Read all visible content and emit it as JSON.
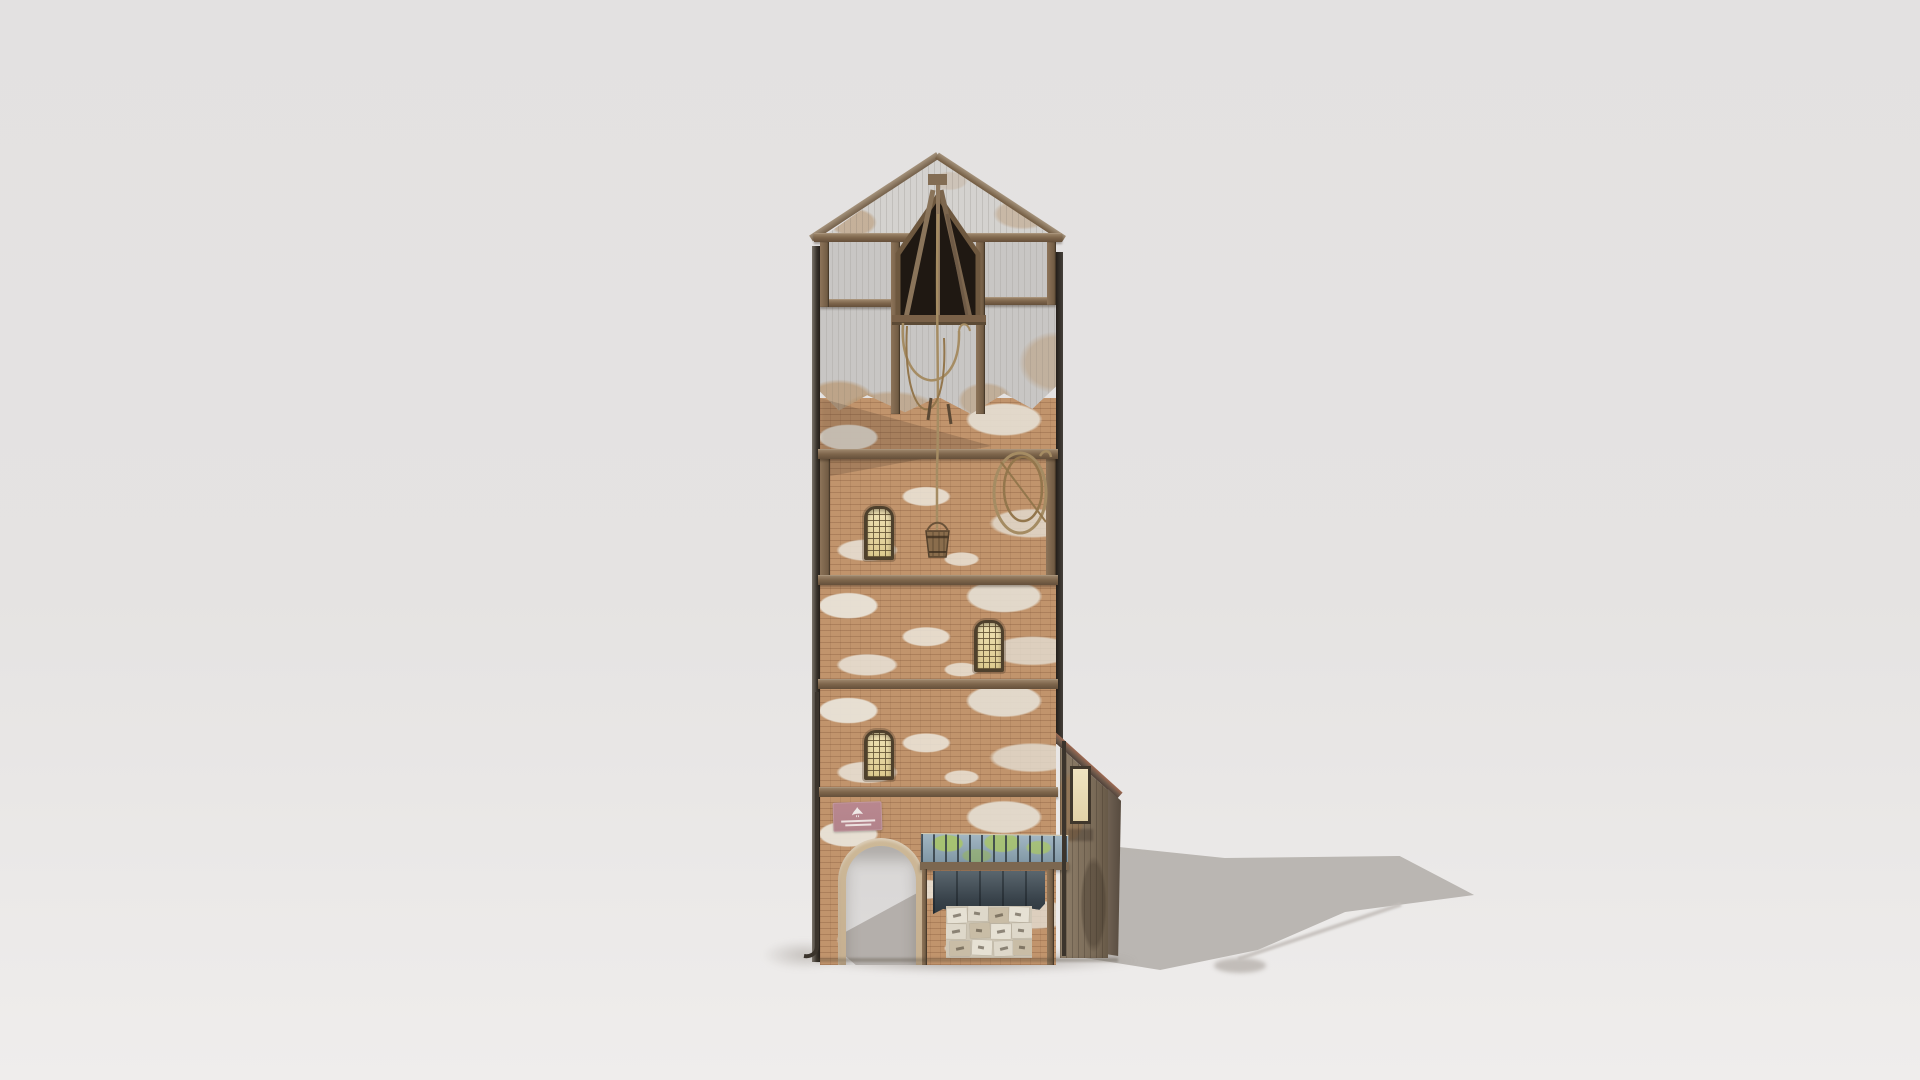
{
  "scene": {
    "type": "3d_render",
    "subject": "tall weathered brick-and-timber tower house with gabled hoist loft, arched passage, boarded shopfront and wooden lean-to shed",
    "background": "#e4e2e1",
    "ground": "#efedec",
    "shadow_color": "#b6b1ad",
    "shadow_direction": "cast to the right of the building"
  },
  "building": {
    "name": "medieval-tower-house",
    "palette": {
      "brick": "#c1946c",
      "plaster": "#c8c6c4",
      "gable_siding": "#d4d2cf",
      "wood": "#7e664c",
      "wood_dark": "#5f4a35",
      "opening_dark": "#1f1812",
      "window_pane": "#e6d7a2",
      "window_frame": "#4e402c",
      "canopy_tile": "#8ea6b4",
      "canopy_moss": "#a8c46a",
      "awning_fabric": "#46525a",
      "poster_paper": "#d7d0c0",
      "sign_pink": "#b2838b",
      "arch_stone": "#c6b091",
      "shed_wood": "#857560",
      "shed_roof_tile": "#9c604c",
      "rope": "#a58c63",
      "side_edge": "#342f29"
    },
    "features": [
      "gabled hoist loft with open timber truss and dark loading opening",
      "rope hanging from hoist down to a small wooden bucket",
      "coiled rope hung on first-floor brick wall",
      "three arched lattice windows with cream panes",
      "horizontal timber floor beams between brick storeys",
      "white plaster patches peeling over brickwork",
      "pink wall sign with white bird emblem and fine print",
      "stone-trimmed arched passage open to the ground behind",
      "tiled shop canopy with green moss",
      "dark rolled canvas awning",
      "poster-covered boarded shop window",
      "narrow wooden lean-to shed with parchment window",
      "dark drainpipes at both front corners"
    ]
  },
  "sign": {
    "icon": "bird",
    "text_legible": false
  }
}
